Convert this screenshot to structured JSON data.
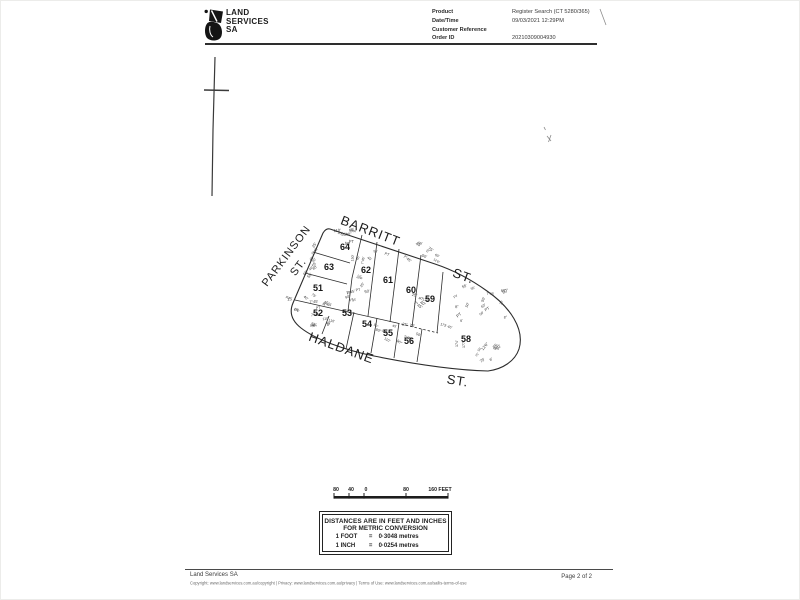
{
  "header": {
    "brand": [
      "LAND",
      "SERVICES",
      "SA"
    ],
    "fields": [
      {
        "label": "Product",
        "value": "Register Search (CT 5280/365)"
      },
      {
        "label": "Date/Time",
        "value": "09/03/2021 12:29PM"
      },
      {
        "label": "Customer Reference",
        "value": ""
      },
      {
        "label": "Order ID",
        "value": "20210309004930"
      }
    ]
  },
  "plan": {
    "streets": [
      {
        "name": "PARKINSON",
        "x": 289,
        "y": 258,
        "r": -53,
        "size": 11
      },
      {
        "name": "ST.",
        "x": 301,
        "y": 269,
        "r": -53,
        "size": 11
      },
      {
        "name": "BARRITT",
        "x": 369,
        "y": 235,
        "r": 21,
        "size": 13
      },
      {
        "name": "ST.",
        "x": 462,
        "y": 280,
        "r": 20,
        "size": 13
      },
      {
        "name": "HALDANE",
        "x": 340,
        "y": 352,
        "r": 20,
        "size": 13
      },
      {
        "name": "ST.",
        "x": 457,
        "y": 385,
        "r": 9,
        "size": 13
      }
    ],
    "lots": [
      {
        "n": "51",
        "x": 318,
        "y": 291
      },
      {
        "n": "52",
        "x": 318,
        "y": 316
      },
      {
        "n": "53",
        "x": 347,
        "y": 316
      },
      {
        "n": "54",
        "x": 367,
        "y": 327
      },
      {
        "n": "55",
        "x": 388,
        "y": 336
      },
      {
        "n": "56",
        "x": 409,
        "y": 344
      },
      {
        "n": "58",
        "x": 466,
        "y": 342
      },
      {
        "n": "59",
        "x": 430,
        "y": 302
      },
      {
        "n": "60",
        "x": 411,
        "y": 293
      },
      {
        "n": "61",
        "x": 388,
        "y": 283
      },
      {
        "n": "62",
        "x": 366,
        "y": 273
      },
      {
        "n": "63",
        "x": 329,
        "y": 270
      },
      {
        "n": "64",
        "x": 345,
        "y": 250
      }
    ],
    "outline": "M330,229 L435,264 Q462,273 487,291 C510,307 525,329 519,349 C515,361 503,369 488,371 C452,370 409,363 374,356 C344,350 315,339 301,328 Q287,317 293,303 L323,233 Q326,228 330,229 Z",
    "boundaries": [
      {
        "d": "M295,300 L397,323"
      },
      {
        "d": "M397,323 L438,333",
        "dash": "2.5,2"
      },
      {
        "d": "M362,235 L352,278 L348,311"
      },
      {
        "d": "M313,252 L350,263"
      },
      {
        "d": "M305,273 L347,284"
      },
      {
        "d": "M377,242 L368,316"
      },
      {
        "d": "M399,249 L390,322"
      },
      {
        "d": "M421,255 L412,327"
      },
      {
        "d": "M443,272 L437,333"
      },
      {
        "d": "M329,316 L322,334"
      },
      {
        "d": "M354,312 L346,349"
      },
      {
        "d": "M377,318 L371,353"
      },
      {
        "d": "M399,323 L394,358"
      },
      {
        "d": "M422,329 L417,362"
      }
    ],
    "noise_strings": [
      "45'",
      "50'",
      "60'",
      "40'",
      "55'",
      "150'",
      "75'",
      "12'6\"",
      "7°45'",
      "8°",
      "25'",
      "PT",
      "110'",
      "90°"
    ],
    "noise_clusters": [
      {
        "x": 333,
        "y": 231,
        "w": 22,
        "h": 16,
        "n": 9,
        "rot": -10,
        "j": 30
      },
      {
        "x": 304,
        "y": 248,
        "w": 16,
        "h": 36,
        "n": 9,
        "rot": -50,
        "j": 25
      },
      {
        "x": 283,
        "y": 293,
        "w": 48,
        "h": 36,
        "n": 19,
        "rot": 15,
        "j": 60
      },
      {
        "x": 343,
        "y": 291,
        "w": 22,
        "h": 16,
        "n": 7,
        "rot": 0,
        "j": 50
      },
      {
        "x": 366,
        "y": 243,
        "w": 70,
        "h": 18,
        "n": 11,
        "rot": 20,
        "j": 35
      },
      {
        "x": 350,
        "y": 325,
        "w": 80,
        "h": 18,
        "n": 11,
        "rot": 20,
        "j": 35
      },
      {
        "x": 452,
        "y": 284,
        "w": 52,
        "h": 40,
        "n": 16,
        "rot": -40,
        "j": 80
      },
      {
        "x": 476,
        "y": 348,
        "w": 24,
        "h": 16,
        "n": 8,
        "rot": -45,
        "j": 30
      },
      {
        "x": 402,
        "y": 294,
        "w": 30,
        "h": 14,
        "n": 5,
        "rot": 20,
        "j": 40
      },
      {
        "x": 353,
        "y": 260,
        "w": 14,
        "h": 28,
        "n": 6,
        "rot": -70,
        "j": 30
      }
    ],
    "noise_singles": [
      {
        "x": 458,
        "y": 347,
        "r": -90,
        "t": "174'"
      },
      {
        "x": 465,
        "y": 348,
        "r": -90,
        "t": "177'"
      },
      {
        "x": 440,
        "y": 325,
        "r": 18,
        "t": "173' 46'"
      }
    ]
  },
  "scalebar": {
    "y_label": 491,
    "y_bar": 496,
    "x1": 334,
    "x2": 448,
    "ticks": [
      334,
      349,
      364,
      406,
      448
    ],
    "labels": [
      {
        "t": "80",
        "x": 336
      },
      {
        "t": "40",
        "x": 351
      },
      {
        "t": "0",
        "x": 366
      },
      {
        "t": "80",
        "x": 406
      },
      {
        "t": "160 FEET",
        "x": 440
      }
    ]
  },
  "conversion": {
    "line1": "DISTANCES ARE IN FEET AND INCHES",
    "line2": "FOR METRIC CONVERSION",
    "rows": [
      {
        "u": "1 FOOT",
        "eq": "=",
        "v": "0·3048 metres"
      },
      {
        "u": "1 INCH",
        "eq": "=",
        "v": "0·0254 metres"
      }
    ]
  },
  "footer": {
    "org": "Land Services SA",
    "copyright": "Copyright: www.landservices.com.au/copyright | Privacy: www.landservices.com.au/privacy | Terms of Use: www.landservices.com.au/sailis-terms-of-use",
    "page": "Page 2 of 2"
  },
  "artifacts": {
    "vline": "M215,57 L213,130 L212,196",
    "cross": "M204,90 L229,90.5",
    "marks": [
      "M544,127 l1.5,3",
      "M547,136 l4,5 M551,135 l-2.5,7",
      "M600,9 l6,16"
    ]
  }
}
